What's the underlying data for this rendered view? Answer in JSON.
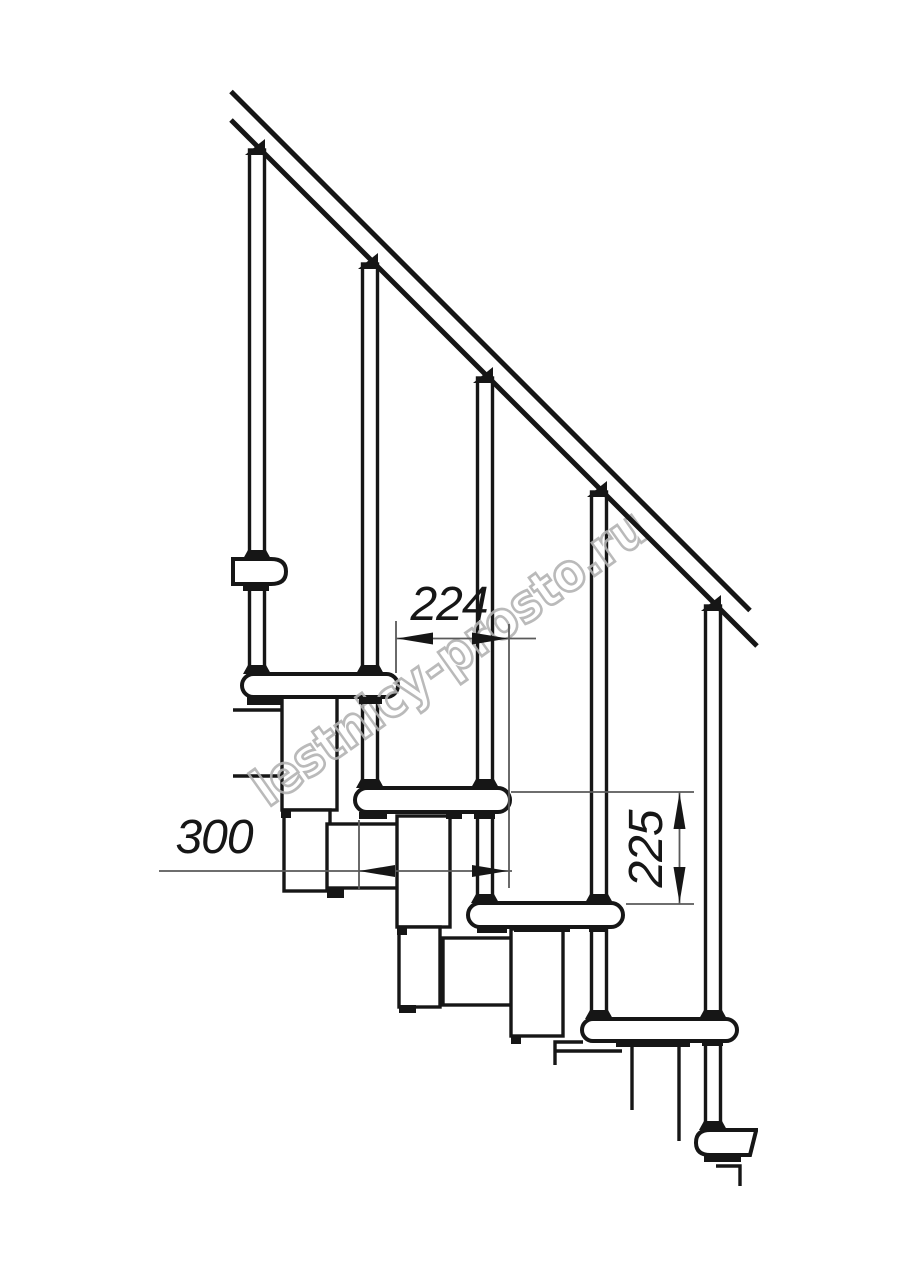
{
  "drawing": {
    "title": "Modular staircase side elevation drawing",
    "dims": {
      "d224": "224",
      "d300": "300",
      "d225": "225"
    },
    "dimension_meanings": [
      {
        "value": "224",
        "orientation": "horizontal",
        "measures": "step run between tread edges"
      },
      {
        "value": "300",
        "orientation": "horizontal",
        "measures": "tread depth"
      },
      {
        "value": "225",
        "orientation": "vertical",
        "measures": "riser height between treads"
      }
    ],
    "watermark": "lestnicy-prosto.ru",
    "colors": {
      "ink": "#161616",
      "thin": "#5a5a5a",
      "wm": "#b3b3b3",
      "bg": "#ffffff"
    }
  }
}
